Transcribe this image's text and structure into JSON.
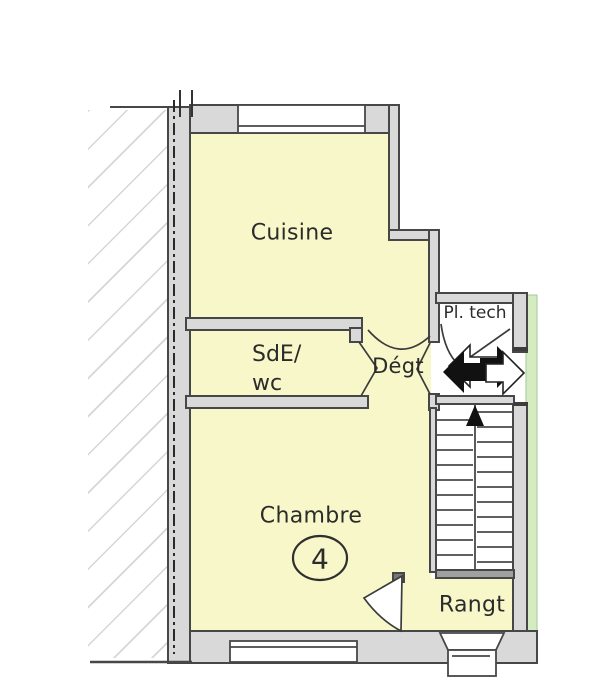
{
  "rooms": {
    "cuisine": {
      "label": "Cuisine"
    },
    "sde_wc": {
      "line1": "SdE/",
      "line2": "wc"
    },
    "degt": {
      "label": "Dégt"
    },
    "pl_tech": {
      "label": "Pl. tech"
    },
    "chambre": {
      "label": "Chambre",
      "number": "4"
    },
    "rangt": {
      "label": "Rangt"
    }
  },
  "icons": {
    "stairs_up_arrow": "up-direction-arrow",
    "landing_left_arrow": "block-arrow-left",
    "landing_right_arrow": "block-arrow-right"
  },
  "colors": {
    "room_fill": "#f7f7c9",
    "wall_fill": "#d9d9d9",
    "wall_line": "#474747",
    "green_strip": "#d5ecc3",
    "hatch_line": "#c8c8c8",
    "text": "#2b2b2b"
  }
}
